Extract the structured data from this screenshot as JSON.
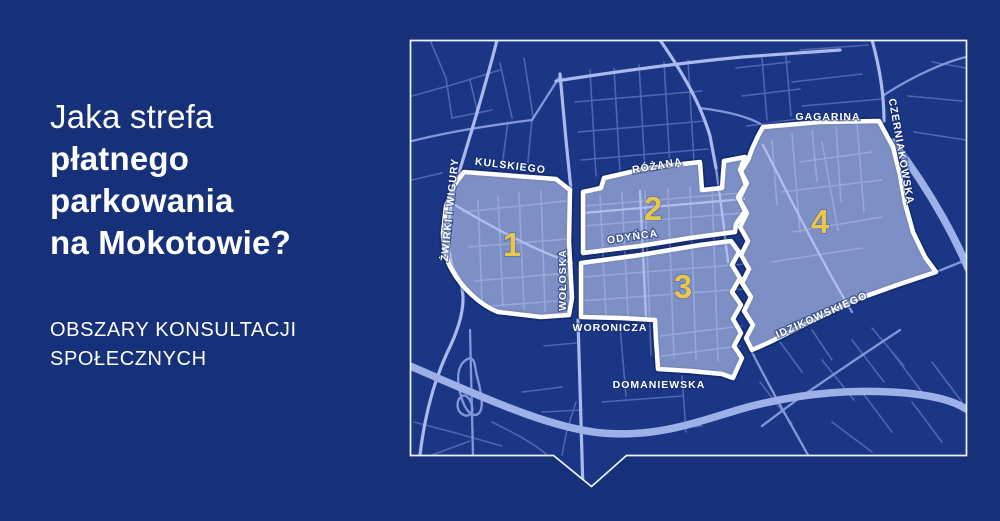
{
  "panel": {
    "title": {
      "line1": "Jaka strefa",
      "line2": "płatnego",
      "line3": "parkowania",
      "line4": "na Mokotowie?"
    },
    "subtitle": {
      "line1": "OBSZARY KONSULTACJI",
      "line2": "SPOŁECZNYCH"
    }
  },
  "map": {
    "zone_numbers": [
      "1",
      "2",
      "3",
      "4"
    ],
    "street_labels": [
      "ŻWIRKI I WIGURY",
      "KULSKIEGO",
      "RÓŻANA",
      "ODYŃCA",
      "WOŁOSKA",
      "WORONICZA",
      "DOMANIEWSKA",
      "GAGARINA",
      "CZERNIAKOWSKA",
      "IDZIKOWSKIEGO"
    ]
  },
  "colors": {
    "background": "#163179",
    "map_background": "#1b3685",
    "road_minor": "#5066b2",
    "road_major": "#aab9ee",
    "road_wide": "#9db0e8",
    "zone_fill": "rgba(216,227,255,0.52)",
    "zone_border": "#ffffff",
    "zone_number": "#e9c74b",
    "text": "#ffffff",
    "frame": "#eef2fb"
  }
}
